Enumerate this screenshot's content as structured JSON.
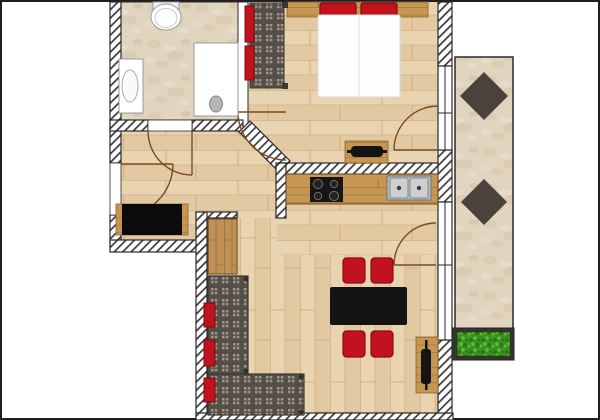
{
  "meta": {
    "title": "apartment-floor-plan",
    "width": 600,
    "height": 420,
    "background": "#ffffff"
  },
  "palette": {
    "wall_outline": "#2a2a2a",
    "hatch_stripe": "#3b3b3b",
    "wood_floor": "#e9d4b1",
    "stone_floor": "#e1d5c0",
    "counter_wood": "#c69753",
    "furniture_wood": "#c49758",
    "accent_red": "#c1121e",
    "accent_red_dark": "#7c0a13",
    "fabric_dark": "#564f49",
    "fabric_dot": "#a09788",
    "table_black": "#141414",
    "tile_dark": "#49433c",
    "plant_green": "#3a941f",
    "door_arc": "#7b4a22"
  },
  "rooms": [
    {
      "name": "bathroom",
      "floor": "stone"
    },
    {
      "name": "bedroom",
      "floor": "wood"
    },
    {
      "name": "hallway",
      "floor": "wood"
    },
    {
      "name": "kitchen-living-room",
      "floor": "wood"
    },
    {
      "name": "balcony",
      "floor": "stone"
    }
  ],
  "shapes": [
    {
      "name": "image-frame",
      "kind": "rect",
      "x": 1,
      "y": 1,
      "w": 598,
      "h": 418,
      "fill": "#ffffff",
      "stroke": "#1f1f1f",
      "sw": 2
    },
    {
      "name": "bathroom-floor",
      "kind": "rect",
      "x": 119,
      "y": 2,
      "w": 119,
      "h": 118,
      "fill": "p:stone",
      "stroke": "#2a2a2a",
      "sw": 1
    },
    {
      "name": "bedroom-floor",
      "kind": "rect",
      "x": 246,
      "y": 2,
      "w": 194,
      "h": 172,
      "fill": "p:woodh"
    },
    {
      "name": "bathroom-east-wall",
      "kind": "rect",
      "x": 238,
      "y": 2,
      "w": 10,
      "h": 129,
      "fill": "#ffffff",
      "stroke": "#2a2a2a",
      "sw": 1
    },
    {
      "name": "hallway-floor",
      "kind": "poly",
      "pts": "121,131 238,131 277,171 277,218 237,218 237,212 196,212 196,240 121,240",
      "fill": "p:woodh"
    },
    {
      "name": "kitchen-floor",
      "kind": "poly",
      "pts": "286,174 438,174 438,255 277,255 277,218 286,218",
      "fill": "p:woodh"
    },
    {
      "name": "living-floor",
      "kind": "poly",
      "pts": "207,218 277,218 277,255 438,255 438,413 207,413",
      "fill": "p:woodv"
    },
    {
      "name": "balcony-floor",
      "kind": "rect",
      "x": 455,
      "y": 57,
      "w": 58,
      "h": 300,
      "fill": "p:stone",
      "stroke": "#2a2a2a",
      "sw": 1.5
    },
    {
      "name": "balcony-tile-1",
      "kind": "poly",
      "pts": "484,72 508,96 484,120 460,96",
      "fill": "#49433c"
    },
    {
      "name": "balcony-tile-2",
      "kind": "poly",
      "pts": "484,179 507,202 484,225 461,202",
      "fill": "#49433c"
    },
    {
      "name": "planter-box",
      "kind": "rect",
      "x": 452,
      "y": 328,
      "w": 62,
      "h": 32,
      "fill": "#35342f",
      "stroke": "#222222",
      "sw": 1
    },
    {
      "name": "planter-grass",
      "kind": "rect",
      "x": 457,
      "y": 332,
      "w": 53,
      "h": 24,
      "fill": "p:grass",
      "stroke": "#222222",
      "sw": 0.5
    },
    {
      "name": "wall-left-upper",
      "kind": "rect",
      "x": 110,
      "y": 2,
      "w": 11,
      "h": 161,
      "fill": "p:hatch",
      "stroke": "#2a2a2a",
      "sw": 1.2
    },
    {
      "name": "wall-left-lower",
      "kind": "rect",
      "x": 110,
      "y": 215,
      "w": 11,
      "h": 30,
      "fill": "p:hatch",
      "stroke": "#2a2a2a",
      "sw": 1.2
    },
    {
      "name": "wall-hall-bottom",
      "kind": "rect",
      "x": 110,
      "y": 240,
      "w": 97,
      "h": 12,
      "fill": "p:hatch",
      "stroke": "#2a2a2a",
      "sw": 1.2
    },
    {
      "name": "wall-bath-south-left",
      "kind": "rect",
      "x": 110,
      "y": 120,
      "w": 38,
      "h": 11,
      "fill": "p:hatch",
      "stroke": "#2a2a2a",
      "sw": 1.2
    },
    {
      "name": "wall-bath-south-right",
      "kind": "rect",
      "x": 192,
      "y": 120,
      "w": 51,
      "h": 11,
      "fill": "p:hatch",
      "stroke": "#2a2a2a",
      "sw": 1.2
    },
    {
      "name": "wall-diagonal",
      "kind": "poly",
      "pts": "239,132 250,121 290,161 279,172",
      "fill": "p:hatch",
      "stroke": "#2a2a2a",
      "sw": 1.2
    },
    {
      "name": "wall-bedroom-south",
      "kind": "rect",
      "x": 283,
      "y": 163,
      "w": 157,
      "h": 11,
      "fill": "p:hatch",
      "stroke": "#2a2a2a",
      "sw": 1.2
    },
    {
      "name": "wall-kitchen-west",
      "kind": "rect",
      "x": 276,
      "y": 163,
      "w": 10,
      "h": 55,
      "fill": "p:hatch",
      "stroke": "#2a2a2a",
      "sw": 1.2
    },
    {
      "name": "wall-hall-living",
      "kind": "rect",
      "x": 196,
      "y": 212,
      "w": 41,
      "h": 6,
      "fill": "p:hatch",
      "stroke": "#2a2a2a",
      "sw": 1.2
    },
    {
      "name": "wall-living-west",
      "kind": "rect",
      "x": 196,
      "y": 212,
      "w": 11,
      "h": 201,
      "fill": "p:hatch",
      "stroke": "#2a2a2a",
      "sw": 1.2
    },
    {
      "name": "wall-bottom",
      "kind": "rect",
      "x": 196,
      "y": 413,
      "w": 257,
      "h": 7,
      "fill": "p:hatch",
      "stroke": "#2a2a2a",
      "sw": 1.2
    },
    {
      "name": "wall-right-upper",
      "kind": "rect",
      "x": 438,
      "y": 2,
      "w": 14,
      "h": 64,
      "fill": "p:hatch",
      "stroke": "#2a2a2a",
      "sw": 1.2
    },
    {
      "name": "wall-right-middle",
      "kind": "rect",
      "x": 438,
      "y": 150,
      "w": 14,
      "h": 52,
      "fill": "p:hatch",
      "stroke": "#2a2a2a",
      "sw": 1.2
    },
    {
      "name": "wall-right-lower",
      "kind": "rect",
      "x": 438,
      "y": 340,
      "w": 14,
      "h": 73,
      "fill": "p:hatch",
      "stroke": "#2a2a2a",
      "sw": 1.2
    },
    {
      "name": "window-bedroom",
      "kind": "rect",
      "x": 438,
      "y": 66,
      "w": 14,
      "h": 84,
      "fill": "#ffffff",
      "stroke": "#2a2a2a",
      "sw": 1.2
    },
    {
      "name": "window-bedroom-mullion",
      "kind": "line",
      "x1": 438,
      "y1": 113,
      "x2": 452,
      "y2": 113,
      "stroke": "#2a2a2a",
      "sw": 1
    },
    {
      "name": "window-bedroom-glass",
      "kind": "line",
      "x1": 445,
      "y1": 66,
      "x2": 445,
      "y2": 150,
      "stroke": "#2a2a2a",
      "sw": 1
    },
    {
      "name": "window-living",
      "kind": "rect",
      "x": 438,
      "y": 202,
      "w": 14,
      "h": 138,
      "fill": "#ffffff",
      "stroke": "#2a2a2a",
      "sw": 1.2
    },
    {
      "name": "window-living-mullion",
      "kind": "line",
      "x1": 438,
      "y1": 265,
      "x2": 452,
      "y2": 265,
      "stroke": "#2a2a2a",
      "sw": 1
    },
    {
      "name": "window-living-glass",
      "kind": "line",
      "x1": 445,
      "y1": 202,
      "x2": 445,
      "y2": 340,
      "stroke": "#2a2a2a",
      "sw": 1
    },
    {
      "name": "entrance-door-opening",
      "kind": "rect",
      "x": 110,
      "y": 163,
      "w": 11,
      "h": 52,
      "fill": "#ffffff",
      "stroke": "#2a2a2a",
      "sw": 0.8
    },
    {
      "name": "bathroom-door-opening",
      "kind": "rect",
      "x": 148,
      "y": 120,
      "w": 44,
      "h": 11,
      "fill": "#ffffff",
      "stroke": "#2a2a2a",
      "sw": 0.8
    },
    {
      "name": "entrance-door-leaf",
      "kind": "line",
      "x1": 121,
      "y1": 164,
      "x2": 173,
      "y2": 164,
      "stroke": "#7b4a22",
      "sw": 1.4
    },
    {
      "name": "entrance-door-arc",
      "kind": "path",
      "d": "M173,164 A52,52 0 0 1 121,216",
      "fill": "none",
      "stroke": "#7b4a22",
      "sw": 1.4
    },
    {
      "name": "bathroom-door-leaf",
      "kind": "line",
      "x1": 192,
      "y1": 131,
      "x2": 192,
      "y2": 175,
      "stroke": "#7b4a22",
      "sw": 1.4
    },
    {
      "name": "bathroom-door-arc",
      "kind": "path",
      "d": "M148,131 A44,44 0 0 0 192,175",
      "fill": "none",
      "stroke": "#7b4a22",
      "sw": 1.4
    },
    {
      "name": "bedroom-door-leaf",
      "kind": "line",
      "x1": 286,
      "y1": 112,
      "x2": 238,
      "y2": 112,
      "stroke": "#7b4a22",
      "sw": 1.4
    },
    {
      "name": "bedroom-door-arc",
      "kind": "path",
      "d": "M238,112 A48,48 0 0 0 286,160",
      "fill": "none",
      "stroke": "#7b4a22",
      "sw": 1.4
    },
    {
      "name": "bedroom-balcony-door-leaf",
      "kind": "line",
      "x1": 438,
      "y1": 150,
      "x2": 394,
      "y2": 150,
      "stroke": "#7b4a22",
      "sw": 1.4
    },
    {
      "name": "bedroom-balcony-door-arc",
      "kind": "path",
      "d": "M394,150 A44,44 0 0 1 438,106",
      "fill": "none",
      "stroke": "#7b4a22",
      "sw": 1.4
    },
    {
      "name": "living-balcony-door-leaf",
      "kind": "line",
      "x1": 436,
      "y1": 265,
      "x2": 394,
      "y2": 265,
      "stroke": "#7b4a22",
      "sw": 1.4
    },
    {
      "name": "living-balcony-door-arc",
      "kind": "path",
      "d": "M394,265 A42,42 0 0 1 436,223",
      "fill": "none",
      "stroke": "#7b4a22",
      "sw": 1.4
    },
    {
      "name": "toilet-tank",
      "kind": "rect",
      "x": 153,
      "y": 2,
      "w": 26,
      "h": 7,
      "fill": "#f2f2f2",
      "stroke": "#9a9a9a",
      "sw": 1
    },
    {
      "name": "toilet-bowl",
      "kind": "ellipse",
      "cx": 166,
      "cy": 17,
      "rx": 15,
      "ry": 13,
      "fill": "#ffffff",
      "stroke": "#9a9a9a",
      "sw": 1
    },
    {
      "name": "toilet-seat",
      "kind": "ellipse",
      "cx": 166,
      "cy": 18,
      "rx": 11,
      "ry": 9.5,
      "fill": "none",
      "stroke": "#c9c9c9",
      "sw": 1
    },
    {
      "name": "vanity",
      "kind": "rect",
      "x": 119,
      "y": 59,
      "w": 24,
      "h": 54,
      "fill": "#ffffff",
      "stroke": "#9a9a9a",
      "sw": 1
    },
    {
      "name": "vanity-basin",
      "kind": "ellipse",
      "cx": 130,
      "cy": 86,
      "rx": 8,
      "ry": 16,
      "fill": "#fafafa",
      "stroke": "#adadad",
      "sw": 1
    },
    {
      "name": "shower",
      "kind": "rect",
      "x": 194,
      "y": 43,
      "w": 44,
      "h": 73,
      "fill": "#ffffff",
      "stroke": "#9a9a9a",
      "sw": 1
    },
    {
      "name": "shower-drain",
      "kind": "ellipse",
      "cx": 216,
      "cy": 104,
      "rx": 6.5,
      "ry": 8,
      "fill": "#b5b5b5",
      "stroke": "#8c8c8c",
      "sw": 1
    },
    {
      "name": "bed-headboard",
      "kind": "rect",
      "x": 287,
      "y": 2,
      "w": 141,
      "h": 15,
      "fill": "p:cwood",
      "stroke": "#8a6436",
      "sw": 0.8
    },
    {
      "name": "bed-pillow-left",
      "kind": "rect",
      "x": 320,
      "y": 3,
      "w": 36,
      "h": 13,
      "rx": 2,
      "fill": "#c1121e",
      "stroke": "#7c0a13",
      "sw": 1.2
    },
    {
      "name": "bed-pillow-right",
      "kind": "rect",
      "x": 361,
      "y": 3,
      "w": 36,
      "h": 13,
      "rx": 2,
      "fill": "#c1121e",
      "stroke": "#7c0a13",
      "sw": 1.2
    },
    {
      "name": "bed-duvet",
      "kind": "rect",
      "x": 318,
      "y": 15,
      "w": 82,
      "h": 82,
      "rx": 2,
      "fill": "#fdfdfd",
      "stroke": "#dcdcdc",
      "sw": 1
    },
    {
      "name": "bed-duvet-seam",
      "kind": "line",
      "x1": 359,
      "y1": 16,
      "x2": 359,
      "y2": 96,
      "stroke": "#e8e8e8",
      "sw": 1.5
    },
    {
      "name": "wardrobe-body",
      "kind": "rect",
      "x": 250,
      "y": 3,
      "w": 34,
      "h": 85,
      "fill": "p:check",
      "stroke": "#3b3631",
      "sw": 1
    },
    {
      "name": "wardrobe-post-top",
      "kind": "rect",
      "x": 282,
      "y": 2,
      "w": 6,
      "h": 6,
      "fill": "#3b3631"
    },
    {
      "name": "wardrobe-post-bottom",
      "kind": "rect",
      "x": 282,
      "y": 83,
      "w": 6,
      "h": 6,
      "fill": "#3b3631"
    },
    {
      "name": "wardrobe-cushion-1",
      "kind": "rect",
      "x": 245,
      "y": 6,
      "w": 9,
      "h": 36,
      "fill": "#c1121e",
      "stroke": "#7c0a13",
      "sw": 1
    },
    {
      "name": "wardrobe-cushion-2",
      "kind": "rect",
      "x": 245,
      "y": 46,
      "w": 9,
      "h": 34,
      "fill": "#c1121e",
      "stroke": "#7c0a13",
      "sw": 1
    },
    {
      "name": "tv-board",
      "kind": "rect",
      "x": 345,
      "y": 141,
      "w": 43,
      "h": 22,
      "fill": "p:cwood",
      "stroke": "#8a6436",
      "sw": 0.8
    },
    {
      "name": "bedroom-tv-bar",
      "kind": "rect",
      "x": 347,
      "y": 150,
      "w": 40,
      "h": 3,
      "fill": "#131313"
    },
    {
      "name": "bedroom-tv",
      "kind": "rect",
      "x": 351,
      "y": 146,
      "w": 32,
      "h": 11,
      "rx": 4,
      "fill": "#131313"
    },
    {
      "name": "entry-sideboard-base",
      "kind": "rect",
      "x": 116,
      "y": 204,
      "w": 72,
      "h": 31,
      "fill": "p:cwood",
      "stroke": "#8a6436",
      "sw": 0.8
    },
    {
      "name": "entry-sideboard",
      "kind": "rect",
      "x": 122,
      "y": 204,
      "w": 60,
      "h": 31,
      "fill": "#0b0b0b"
    },
    {
      "name": "hall-cabinet",
      "kind": "rect",
      "x": 208,
      "y": 219,
      "w": 29,
      "h": 55,
      "fill": "p:plankv",
      "stroke": "#6b4a24",
      "sw": 1
    },
    {
      "name": "kitchen-counter",
      "kind": "rect",
      "x": 286,
      "y": 174,
      "w": 152,
      "h": 30,
      "fill": "p:cwood",
      "stroke": "#6b4a24",
      "sw": 1
    },
    {
      "name": "cooktop",
      "kind": "rect",
      "x": 310,
      "y": 177,
      "w": 33,
      "h": 25,
      "fill": "#161616"
    },
    {
      "name": "burner-1",
      "kind": "circle",
      "cx": 318,
      "cy": 184,
      "r": 4.6,
      "fill": "#222222",
      "stroke": "#6e6e6e",
      "sw": 1
    },
    {
      "name": "burner-2",
      "kind": "circle",
      "cx": 334,
      "cy": 184,
      "r": 3.6,
      "fill": "#222222",
      "stroke": "#6e6e6e",
      "sw": 1
    },
    {
      "name": "burner-3",
      "kind": "circle",
      "cx": 318,
      "cy": 196,
      "r": 3.6,
      "fill": "#222222",
      "stroke": "#6e6e6e",
      "sw": 1
    },
    {
      "name": "burner-4",
      "kind": "circle",
      "cx": 334,
      "cy": 196,
      "r": 4.6,
      "fill": "#222222",
      "stroke": "#6e6e6e",
      "sw": 1
    },
    {
      "name": "sink-unit",
      "kind": "rect",
      "x": 387,
      "y": 176,
      "w": 44,
      "h": 24,
      "fill": "#b7babc",
      "stroke": "#6f7477",
      "sw": 1
    },
    {
      "name": "sink-basin-left",
      "kind": "rect",
      "x": 390,
      "y": 178,
      "w": 18,
      "h": 20,
      "rx": 2,
      "fill": "#ccd0d2",
      "stroke": "#85898c",
      "sw": 1
    },
    {
      "name": "sink-basin-right",
      "kind": "rect",
      "x": 410,
      "y": 178,
      "w": 18,
      "h": 20,
      "rx": 2,
      "fill": "#ccd0d2",
      "stroke": "#85898c",
      "sw": 1
    },
    {
      "name": "sink-tap-left",
      "kind": "circle",
      "cx": 399,
      "cy": 188,
      "r": 2.2,
      "fill": "#3c3c3c"
    },
    {
      "name": "sink-tap-right",
      "kind": "circle",
      "cx": 419,
      "cy": 188,
      "r": 2.2,
      "fill": "#3c3c3c"
    },
    {
      "name": "dining-table",
      "kind": "rect",
      "x": 330,
      "y": 287,
      "w": 77,
      "h": 38,
      "rx": 2,
      "fill": "#141414"
    },
    {
      "name": "dining-chair-1",
      "kind": "rect",
      "x": 343,
      "y": 258,
      "w": 22,
      "h": 25,
      "rx": 3.5,
      "fill": "#c1121e",
      "stroke": "#8c0b15",
      "sw": 1.2
    },
    {
      "name": "dining-chair-2",
      "kind": "rect",
      "x": 371,
      "y": 258,
      "w": 22,
      "h": 25,
      "rx": 3.5,
      "fill": "#c1121e",
      "stroke": "#8c0b15",
      "sw": 1.2
    },
    {
      "name": "dining-chair-3",
      "kind": "rect",
      "x": 343,
      "y": 331,
      "w": 22,
      "h": 26,
      "rx": 3.5,
      "fill": "#c1121e",
      "stroke": "#8c0b15",
      "sw": 1.2
    },
    {
      "name": "dining-chair-4",
      "kind": "rect",
      "x": 371,
      "y": 331,
      "w": 22,
      "h": 26,
      "rx": 3.5,
      "fill": "#c1121e",
      "stroke": "#8c0b15",
      "sw": 1.2
    },
    {
      "name": "sofa-vertical",
      "kind": "rect",
      "x": 208,
      "y": 276,
      "w": 40,
      "h": 98,
      "fill": "p:check",
      "stroke": "#3b3631",
      "sw": 1.2
    },
    {
      "name": "sofa-horizontal",
      "kind": "rect",
      "x": 208,
      "y": 374,
      "w": 96,
      "h": 41,
      "fill": "p:check",
      "stroke": "#3b3631",
      "sw": 1.2
    },
    {
      "name": "sofa-pillow-1",
      "kind": "rect",
      "x": 204,
      "y": 303,
      "w": 11,
      "h": 24,
      "fill": "#c1121e",
      "stroke": "#7c0a13",
      "sw": 1
    },
    {
      "name": "sofa-pillow-2",
      "kind": "rect",
      "x": 204,
      "y": 340,
      "w": 11,
      "h": 26,
      "fill": "#c1121e",
      "stroke": "#7c0a13",
      "sw": 1
    },
    {
      "name": "sofa-pillow-3",
      "kind": "rect",
      "x": 204,
      "y": 378,
      "w": 11,
      "h": 24,
      "fill": "#c1121e",
      "stroke": "#7c0a13",
      "sw": 1
    },
    {
      "name": "sofa-post-1",
      "kind": "circle",
      "cx": 246,
      "cy": 279,
      "r": 2.5,
      "fill": "#33302b"
    },
    {
      "name": "sofa-post-2",
      "kind": "circle",
      "cx": 246,
      "cy": 371,
      "r": 2.5,
      "fill": "#33302b"
    },
    {
      "name": "sofa-post-3",
      "kind": "circle",
      "cx": 301,
      "cy": 377,
      "r": 2.5,
      "fill": "#33302b"
    },
    {
      "name": "sofa-post-4",
      "kind": "circle",
      "cx": 301,
      "cy": 412,
      "r": 2.5,
      "fill": "#33302b"
    },
    {
      "name": "tv-sideboard",
      "kind": "rect",
      "x": 416,
      "y": 337,
      "w": 22,
      "h": 56,
      "fill": "p:cwood",
      "stroke": "#8a6436",
      "sw": 0.8
    },
    {
      "name": "living-tv-bar",
      "kind": "rect",
      "x": 425,
      "y": 340,
      "w": 2.5,
      "h": 50,
      "fill": "#141414"
    },
    {
      "name": "living-tv",
      "kind": "rect",
      "x": 421,
      "y": 349,
      "w": 10,
      "h": 35,
      "rx": 3,
      "fill": "#141414"
    }
  ]
}
